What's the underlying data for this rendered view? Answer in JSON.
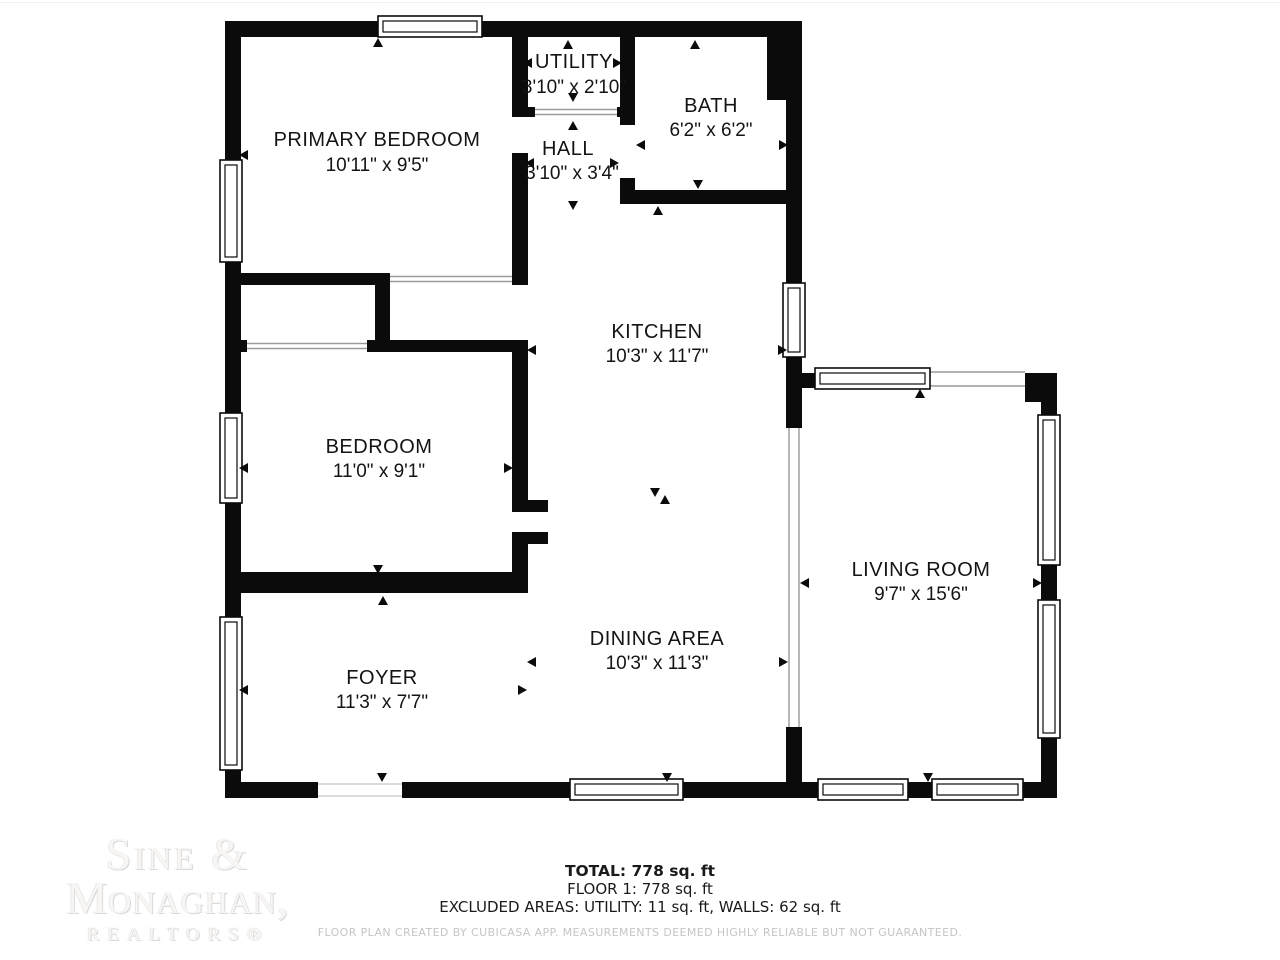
{
  "plan": {
    "wall_color": "#0b0b0b",
    "background": "#ffffff",
    "rooms": [
      {
        "name": "PRIMARY BEDROOM",
        "dims": "10'11\" x 9'5\""
      },
      {
        "name": "UTILITY",
        "dims": "3'10\" x 2'10\""
      },
      {
        "name": "HALL",
        "dims": "3'10\" x 3'4\""
      },
      {
        "name": "BATH",
        "dims": "6'2\" x 6'2\""
      },
      {
        "name": "KITCHEN",
        "dims": "10'3\" x 11'7\""
      },
      {
        "name": "BEDROOM",
        "dims": "11'0\" x 9'1\""
      },
      {
        "name": "LIVING ROOM",
        "dims": "9'7\" x 15'6\""
      },
      {
        "name": "DINING AREA",
        "dims": "10'3\" x 11'3\""
      },
      {
        "name": "FOYER",
        "dims": "11'3\" x 7'7\""
      }
    ]
  },
  "branding": {
    "logo_line1": "Sine &",
    "logo_line2": "Monaghan,",
    "logo_line3": "REALTORS®",
    "logo_color": "#f7f6f5"
  },
  "summary": {
    "total": "TOTAL: 778 sq. ft",
    "floor": "FLOOR 1: 778 sq. ft",
    "excluded": "EXCLUDED AREAS: UTILITY: 11 sq. ft, WALLS: 62 sq. ft",
    "disclaimer": "FLOOR PLAN CREATED BY CUBICASA APP. MEASUREMENTS DEEMED HIGHLY RELIABLE BUT NOT GUARANTEED."
  }
}
